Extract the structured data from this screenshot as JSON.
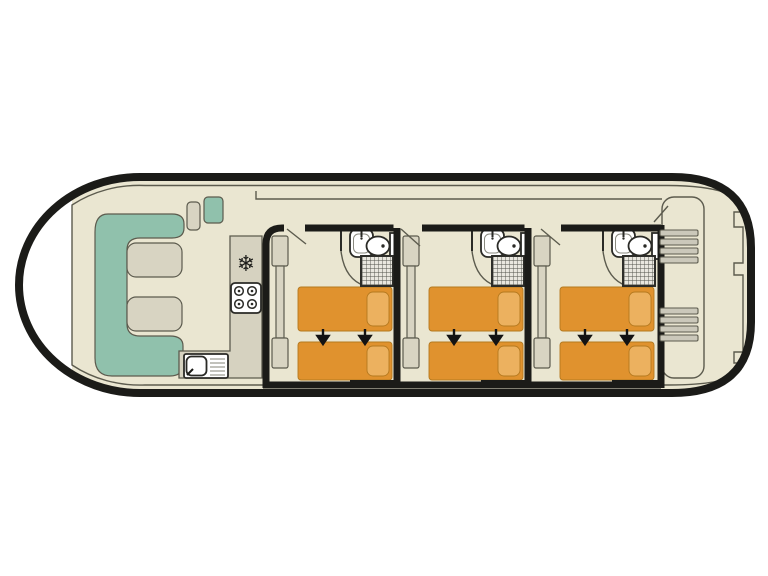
{
  "plan": {
    "vessel": "motor-cruiser deck plan",
    "bow_lounge": {
      "sofa": "U-shaped bench",
      "tables": 2,
      "helm_seats": 2
    },
    "galley": {
      "appliances": [
        "fridge-freezer",
        "4-burner stove",
        "sink with drainer"
      ],
      "burners": 4
    },
    "cabins": [
      {
        "name": "cabin-1",
        "beds": 2,
        "wardrobe": true,
        "bathroom": [
          "washbasin",
          "toilet",
          "shower"
        ],
        "bed_arrows": 2
      },
      {
        "name": "cabin-2",
        "beds": 2,
        "wardrobe": true,
        "bathroom": [
          "washbasin",
          "toilet",
          "shower"
        ],
        "bed_arrows": 2
      },
      {
        "name": "cabin-3",
        "beds": 2,
        "wardrobe": true,
        "bathroom": [
          "washbasin",
          "toilet",
          "shower"
        ],
        "bed_arrows": 2
      }
    ],
    "stern_deck": {
      "stairs": 2,
      "boarding_steps": 3
    }
  },
  "icons": {
    "fridge": "❄"
  },
  "colors": {
    "wall": "#1b1b18",
    "floor": "#eae6d1",
    "outline": "#5c5b4e",
    "furniture": "#d8d4c2",
    "counter": "#d6d2c0",
    "sofa": "#90c1ac",
    "bed": "#e0922e",
    "bedEdge": "#b4791f",
    "pillow": "#ecb15f",
    "fixture": "#ffffff",
    "fixtureEdge": "#2a2a26",
    "stair": "#cbc8ba",
    "showerBase": "#e9e7df",
    "arrow": "#131313"
  }
}
